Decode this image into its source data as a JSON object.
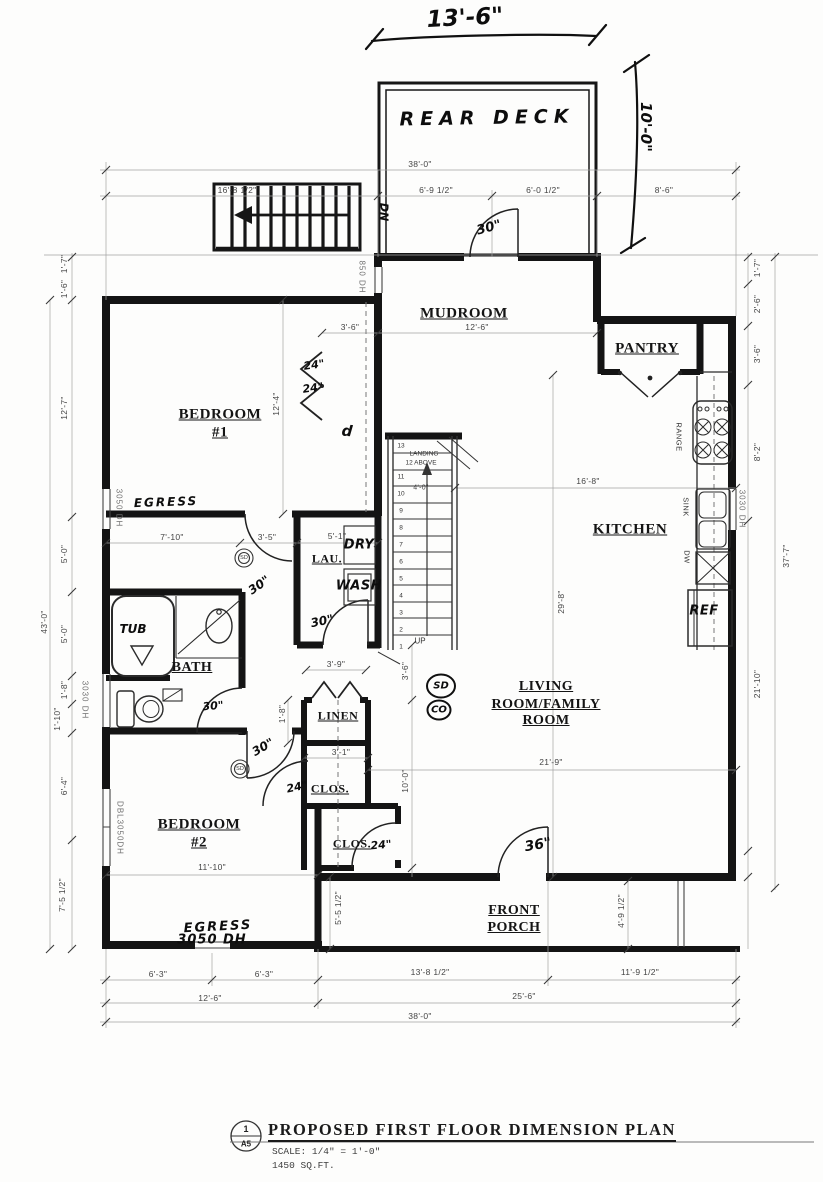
{
  "deck": {
    "label": "REAR DECK",
    "width": "13'-6\"",
    "depth": "10'-0\"",
    "stair_note": "DN"
  },
  "rooms": {
    "mudroom": "MUDROOM",
    "pantry": "PANTRY",
    "kitchen": "KITCHEN",
    "laundry": "LAU.",
    "bath": "BATH",
    "linen": "LINEN",
    "closet_hall": "CLOS.",
    "closet_bed2": "CLOS.",
    "bedroom1_line1": "BEDROOM",
    "bedroom1_line2": "#1",
    "bedroom2_line1": "BEDROOM",
    "bedroom2_line2": "#2",
    "living_line1": "LIVING",
    "living_line2": "ROOM/FAMILY",
    "living_line3": "ROOM",
    "porch_line1": "FRONT",
    "porch_line2": "PORCH"
  },
  "dims": {
    "top": [
      "38'-0\"",
      "16'-8 1/2\"",
      "6'-9 1/2\"",
      "6'-0 1/2\"",
      "8'-6\""
    ],
    "left": [
      "1'-7\"",
      "1'-6\"",
      "12'-7\"",
      "5'-0\"",
      "5'-0\"",
      "1'-8\"",
      "1'-10\"",
      "6'-4\"",
      "7'-5 1/2\"",
      "43'-0\""
    ],
    "right": [
      "1'-7\"",
      "2'-6\"",
      "3'-6\"",
      "8'-2\"",
      "21'-10\"",
      "37'-7\""
    ],
    "bottom": [
      "6'-3\"",
      "6'-3\"",
      "13'-8 1/2\"",
      "11'-9 1/2\"",
      "12'-6\"",
      "25'-6\"",
      "38'-0\""
    ],
    "interior": {
      "mudroom_width": "12'-6\"",
      "closet1_width": "3'-6\"",
      "bed1_depth": "12'-4\"",
      "bed1_width": "7'-10\"",
      "hall_width": "3'-5\"",
      "laundry_width": "5'-1\"",
      "stair_width": "4'-0\"",
      "kitchen_width": "16'-8\"",
      "living_depth": "29'-8\"",
      "living_width": "21'-9\"",
      "linen_width": "3'-9\"",
      "linen_depth": "3'-6\"",
      "linen_side": "1'-8\"",
      "hall_depth": "10'-0\"",
      "closet_row_width": "3'-1\"",
      "bed2_width": "11'-10\"",
      "porch_depth_left": "5'-5 1/2\"",
      "porch_depth_right": "4'-9 1/2\""
    }
  },
  "windows": {
    "bed1_left": "3050 DH",
    "mudroom_left": "850 DH",
    "bath_left": "3030 DH",
    "bed2_left": "DBL3050DH",
    "bed2_front": "3050 DH",
    "kitchen_right": "3030 DH"
  },
  "annotations": {
    "egress_bed1": "EGRESS",
    "egress_bed2": "EGRESS",
    "tub": "TUB",
    "door_rear": "30\"",
    "door_bed1": "30\"",
    "door_laundry": "30\"",
    "door_bath": "30\"",
    "door_bed2": "30\"",
    "door_front": "36\"",
    "bifold_a": "24\"",
    "bifold_b": "24\"",
    "closet_hall_door": "24\"",
    "closet_bed2_door": "24\"",
    "closet_mark": "d",
    "smoke_detector_hw": "SD",
    "co_detector_hw": "CO",
    "smoke_detector_1": "SD",
    "smoke_detector_2": "SD"
  },
  "appliances": {
    "range": "RANGE",
    "sink": "SINK",
    "dishwasher": "DW",
    "refrigerator": "REF",
    "dryer": "DRY",
    "washer": "WASH"
  },
  "stairs": {
    "numbers": [
      "13",
      "11",
      "10",
      "9",
      "8",
      "7",
      "6",
      "5",
      "4",
      "3",
      "2",
      "1"
    ],
    "landing_note_1": "LANDING",
    "landing_note_2": "12 ABOVE",
    "up_label": "UP"
  },
  "title_block": {
    "detail_number": "1",
    "sheet_ref": "A5",
    "title": "PROPOSED FIRST FLOOR DIMENSION PLAN",
    "scale_note": "SCALE: 1/4\" = 1'-0\"",
    "area_note": "1450 SQ.FT."
  }
}
